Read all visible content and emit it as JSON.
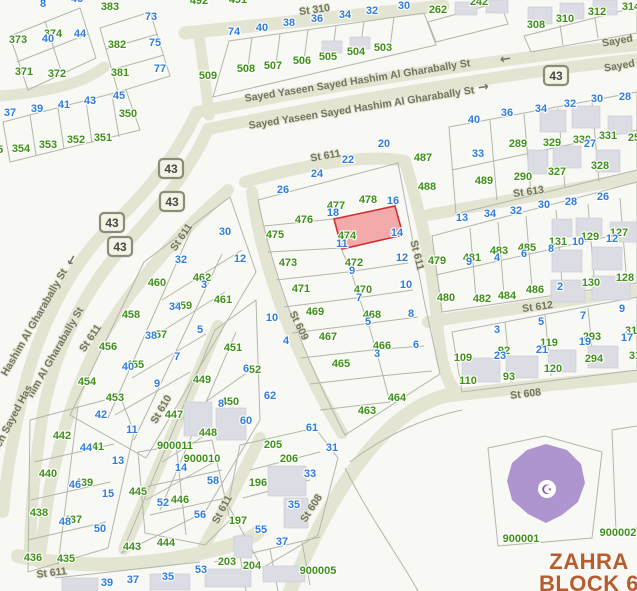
{
  "map": {
    "colors": {
      "background": "#f8f8f5",
      "road_fill": "#e3e4d1",
      "parcel_green": "#3f9018",
      "lot_blue": "#2e7ce2",
      "street_gray": "#73735f",
      "building_fill": "#dcdde4",
      "parcel_line": "#b3b6aa",
      "highlight_fill": "#f29090",
      "highlight_border": "#d42f2f",
      "mosque_purple": "#af95cf",
      "mosque_icon_purple": "#7b55ad",
      "block_label_orange": "#b85c2e",
      "badge_fill": "#f4f3e7",
      "badge_border": "#8c8c78"
    },
    "block_label": {
      "line1": "ZAHRA",
      "line2": "BLOCK 6"
    },
    "landmarks": {
      "mosque_icon": "☪"
    },
    "route_badge": {
      "text": "43",
      "positions": [
        [
          171,
          169
        ],
        [
          172,
          202
        ],
        [
          112,
          223
        ],
        [
          120,
          247
        ],
        [
          556,
          76
        ]
      ]
    },
    "arrows": [
      {
        "g": "←",
        "x": 506,
        "y": 63,
        "r": -9
      },
      {
        "g": "→",
        "x": 484,
        "y": 91,
        "r": -9
      },
      {
        "g": "←",
        "x": 75,
        "y": 262,
        "r": -60
      }
    ],
    "street_labels": [
      [
        "St 310",
        315,
        13,
        -8
      ],
      [
        "Sayed Yaseen Sayed Hashim Al Gharabally St",
        358,
        84,
        -9
      ],
      [
        "Sayed Yaseen Sayed Hashim Al Gharabally St",
        362,
        111,
        -9
      ],
      [
        "Sayed",
        618,
        44,
        -10
      ],
      [
        "Sayed",
        620,
        69,
        -10
      ],
      [
        "St 611",
        326,
        159,
        -10
      ],
      [
        "St 611",
        414,
        256,
        76
      ],
      [
        "St 611",
        184,
        239,
        -56
      ],
      [
        "St 611",
        93,
        340,
        -56
      ],
      [
        "St 611",
        52,
        576,
        -7
      ],
      [
        "St 611",
        225,
        511,
        -62
      ],
      [
        "St 610",
        164,
        411,
        -60
      ],
      [
        "St 609",
        296,
        327,
        64
      ],
      [
        "St 608",
        314,
        510,
        -57
      ],
      [
        "St 608",
        526,
        397,
        -7
      ],
      [
        "St 612",
        538,
        310,
        -8
      ],
      [
        "St 613",
        529,
        195,
        -8
      ],
      [
        "Hashim Al Gharabally St",
        37,
        324,
        -60
      ],
      [
        "him Al Gharabally St",
        58,
        354,
        -60
      ],
      [
        "een Sayed Has",
        15,
        420,
        -62
      ]
    ],
    "parcel_numbers": [
      [
        "373",
        18,
        43
      ],
      [
        "374",
        53,
        37
      ],
      [
        "371",
        24,
        75
      ],
      [
        "372",
        57,
        77
      ],
      [
        "383",
        110,
        10
      ],
      [
        "382",
        117,
        48
      ],
      [
        "381",
        120,
        76
      ],
      [
        "350",
        128,
        117
      ],
      [
        "351",
        103,
        141
      ],
      [
        "352",
        76,
        143
      ],
      [
        "353",
        48,
        148
      ],
      [
        "354",
        21,
        152
      ],
      [
        "355",
        -6,
        153
      ],
      [
        "492",
        199,
        4
      ],
      [
        "491",
        238,
        3
      ],
      [
        "509",
        208,
        79
      ],
      [
        "508",
        246,
        72
      ],
      [
        "507",
        273,
        69
      ],
      [
        "506",
        302,
        64
      ],
      [
        "505",
        328,
        60
      ],
      [
        "504",
        356,
        55
      ],
      [
        "503",
        383,
        51
      ],
      [
        "262",
        438,
        13
      ],
      [
        "242",
        479,
        5
      ],
      [
        "308",
        536,
        28
      ],
      [
        "310",
        565,
        22
      ],
      [
        "312",
        597,
        15
      ],
      [
        "314",
        631,
        10
      ],
      [
        "487",
        423,
        161
      ],
      [
        "488",
        427,
        190
      ],
      [
        "489",
        484,
        184
      ],
      [
        "290",
        523,
        180
      ],
      [
        "289",
        518,
        147
      ],
      [
        "329",
        552,
        146
      ],
      [
        "330",
        582,
        143
      ],
      [
        "331",
        608,
        139
      ],
      [
        "327",
        557,
        175
      ],
      [
        "328",
        600,
        169
      ],
      [
        "25",
        634,
        141
      ],
      [
        "479",
        437,
        264
      ],
      [
        "481",
        472,
        261
      ],
      [
        "483",
        499,
        254
      ],
      [
        "485",
        527,
        251
      ],
      [
        "131",
        558,
        245
      ],
      [
        "129",
        590,
        240
      ],
      [
        "127",
        619,
        236
      ],
      [
        "480",
        446,
        301
      ],
      [
        "482",
        482,
        302
      ],
      [
        "484",
        507,
        299
      ],
      [
        "486",
        535,
        293
      ],
      [
        "130",
        591,
        286
      ],
      [
        "128",
        625,
        281
      ],
      [
        "119",
        549,
        346
      ],
      [
        "293",
        592,
        340
      ],
      [
        "31",
        631,
        334
      ],
      [
        "92",
        504,
        354
      ],
      [
        "109",
        463,
        361
      ],
      [
        "120",
        553,
        372
      ],
      [
        "294",
        594,
        362
      ],
      [
        "31",
        635,
        359
      ],
      [
        "93",
        509,
        380
      ],
      [
        "110",
        468,
        384
      ],
      [
        "900001",
        521,
        542
      ],
      [
        "900002",
        618,
        536
      ],
      [
        "900005",
        318,
        574
      ],
      [
        "477",
        336,
        209
      ],
      [
        "478",
        368,
        203
      ],
      [
        "476",
        304,
        223
      ],
      [
        "475",
        275,
        238
      ],
      [
        "474",
        347,
        239
      ],
      [
        "473",
        288,
        266
      ],
      [
        "472",
        354,
        266
      ],
      [
        "471",
        301,
        292
      ],
      [
        "470",
        363,
        293
      ],
      [
        "469",
        315,
        315
      ],
      [
        "468",
        372,
        318
      ],
      [
        "467",
        328,
        340
      ],
      [
        "466",
        382,
        349
      ],
      [
        "465",
        341,
        367
      ],
      [
        "464",
        397,
        401
      ],
      [
        "463",
        367,
        414
      ],
      [
        "460",
        157,
        286
      ],
      [
        "462",
        202,
        281
      ],
      [
        "461",
        223,
        303
      ],
      [
        "459",
        183,
        309
      ],
      [
        "458",
        131,
        318
      ],
      [
        "457",
        158,
        338
      ],
      [
        "456",
        108,
        350
      ],
      [
        "455",
        135,
        368
      ],
      [
        "454",
        87,
        385
      ],
      [
        "453",
        115,
        401
      ],
      [
        "451",
        233,
        351
      ],
      [
        "452",
        252,
        373
      ],
      [
        "449",
        202,
        383
      ],
      [
        "450",
        230,
        405
      ],
      [
        "447",
        174,
        418
      ],
      [
        "448",
        208,
        436
      ],
      [
        "445",
        138,
        495
      ],
      [
        "446",
        180,
        503
      ],
      [
        "443",
        132,
        550
      ],
      [
        "444",
        166,
        546
      ],
      [
        "442",
        62,
        439
      ],
      [
        "441",
        95,
        450
      ],
      [
        "440",
        48,
        477
      ],
      [
        "439",
        84,
        486
      ],
      [
        "438",
        39,
        516
      ],
      [
        "437",
        73,
        523
      ],
      [
        "436",
        33,
        561
      ],
      [
        "435",
        66,
        562
      ],
      [
        "900011",
        175,
        449
      ],
      [
        "900010",
        202,
        462
      ],
      [
        "205",
        273,
        448
      ],
      [
        "206",
        289,
        462
      ],
      [
        "196",
        258,
        486
      ],
      [
        "197",
        238,
        524
      ],
      [
        "203",
        227,
        565
      ],
      [
        "204",
        252,
        569
      ]
    ],
    "lot_numbers": [
      [
        "8",
        43,
        7
      ],
      [
        "46",
        77,
        2
      ],
      [
        "40",
        48,
        42
      ],
      [
        "44",
        80,
        37
      ],
      [
        "73",
        151,
        20
      ],
      [
        "75",
        155,
        46
      ],
      [
        "77",
        160,
        72
      ],
      [
        "45",
        119,
        99
      ],
      [
        "43",
        90,
        104
      ],
      [
        "41",
        64,
        108
      ],
      [
        "39",
        37,
        112
      ],
      [
        "37",
        10,
        116
      ],
      [
        "74",
        234,
        35
      ],
      [
        "40",
        262,
        31
      ],
      [
        "38",
        289,
        26
      ],
      [
        "36",
        317,
        22
      ],
      [
        "34",
        345,
        18
      ],
      [
        "32",
        372,
        14
      ],
      [
        "30",
        404,
        9
      ],
      [
        "40",
        474,
        123
      ],
      [
        "36",
        507,
        116
      ],
      [
        "34",
        541,
        112
      ],
      [
        "32",
        570,
        107
      ],
      [
        "30",
        597,
        102
      ],
      [
        "28",
        625,
        100
      ],
      [
        "33",
        478,
        157
      ],
      [
        "27",
        590,
        147
      ],
      [
        "13",
        462,
        221
      ],
      [
        "34",
        490,
        217
      ],
      [
        "32",
        516,
        214
      ],
      [
        "30",
        544,
        208
      ],
      [
        "28",
        571,
        205
      ],
      [
        "26",
        603,
        200
      ],
      [
        "9",
        469,
        265
      ],
      [
        "4",
        497,
        261
      ],
      [
        "6",
        524,
        257
      ],
      [
        "8",
        551,
        252
      ],
      [
        "10",
        578,
        245
      ],
      [
        "12",
        612,
        242
      ],
      [
        "2",
        560,
        290
      ],
      [
        "3",
        497,
        333
      ],
      [
        "5",
        541,
        325
      ],
      [
        "7",
        583,
        319
      ],
      [
        "9",
        622,
        312
      ],
      [
        "23",
        500,
        359
      ],
      [
        "21",
        542,
        353
      ],
      [
        "19",
        585,
        345
      ],
      [
        "17",
        627,
        341
      ],
      [
        "20",
        384,
        147
      ],
      [
        "22",
        348,
        163
      ],
      [
        "24",
        317,
        177
      ],
      [
        "26",
        283,
        193
      ],
      [
        "16",
        393,
        204
      ],
      [
        "18",
        333,
        216
      ],
      [
        "14",
        397,
        236
      ],
      [
        "11",
        342,
        247
      ],
      [
        "12",
        402,
        261
      ],
      [
        "9",
        352,
        274
      ],
      [
        "10",
        406,
        288
      ],
      [
        "7",
        359,
        301
      ],
      [
        "8",
        411,
        317
      ],
      [
        "5",
        368,
        325
      ],
      [
        "6",
        416,
        348
      ],
      [
        "3",
        377,
        357
      ],
      [
        "30",
        225,
        235
      ],
      [
        "32",
        181,
        263
      ],
      [
        "12",
        240,
        262
      ],
      [
        "3",
        204,
        288
      ],
      [
        "34",
        175,
        310
      ],
      [
        "5",
        200,
        333
      ],
      [
        "38",
        151,
        339
      ],
      [
        "7",
        177,
        360
      ],
      [
        "40",
        128,
        370
      ],
      [
        "9",
        157,
        387
      ],
      [
        "10",
        272,
        321
      ],
      [
        "4",
        286,
        344
      ],
      [
        "6",
        246,
        372
      ],
      [
        "8",
        221,
        407
      ],
      [
        "62",
        270,
        399
      ],
      [
        "60",
        246,
        424
      ],
      [
        "61",
        312,
        431
      ],
      [
        "31",
        332,
        451
      ],
      [
        "33",
        310,
        477
      ],
      [
        "35",
        294,
        508
      ],
      [
        "37",
        282,
        545
      ],
      [
        "55",
        261,
        533
      ],
      [
        "42",
        101,
        418
      ],
      [
        "11",
        132,
        433
      ],
      [
        "44",
        86,
        451
      ],
      [
        "13",
        118,
        464
      ],
      [
        "46",
        75,
        488
      ],
      [
        "15",
        108,
        497
      ],
      [
        "48",
        65,
        525
      ],
      [
        "50",
        100,
        532
      ],
      [
        "14",
        181,
        471
      ],
      [
        "58",
        213,
        484
      ],
      [
        "52",
        163,
        506
      ],
      [
        "56",
        200,
        518
      ],
      [
        "53",
        201,
        573
      ],
      [
        "35",
        168,
        580
      ],
      [
        "37",
        133,
        583
      ],
      [
        "39",
        107,
        586
      ]
    ]
  }
}
